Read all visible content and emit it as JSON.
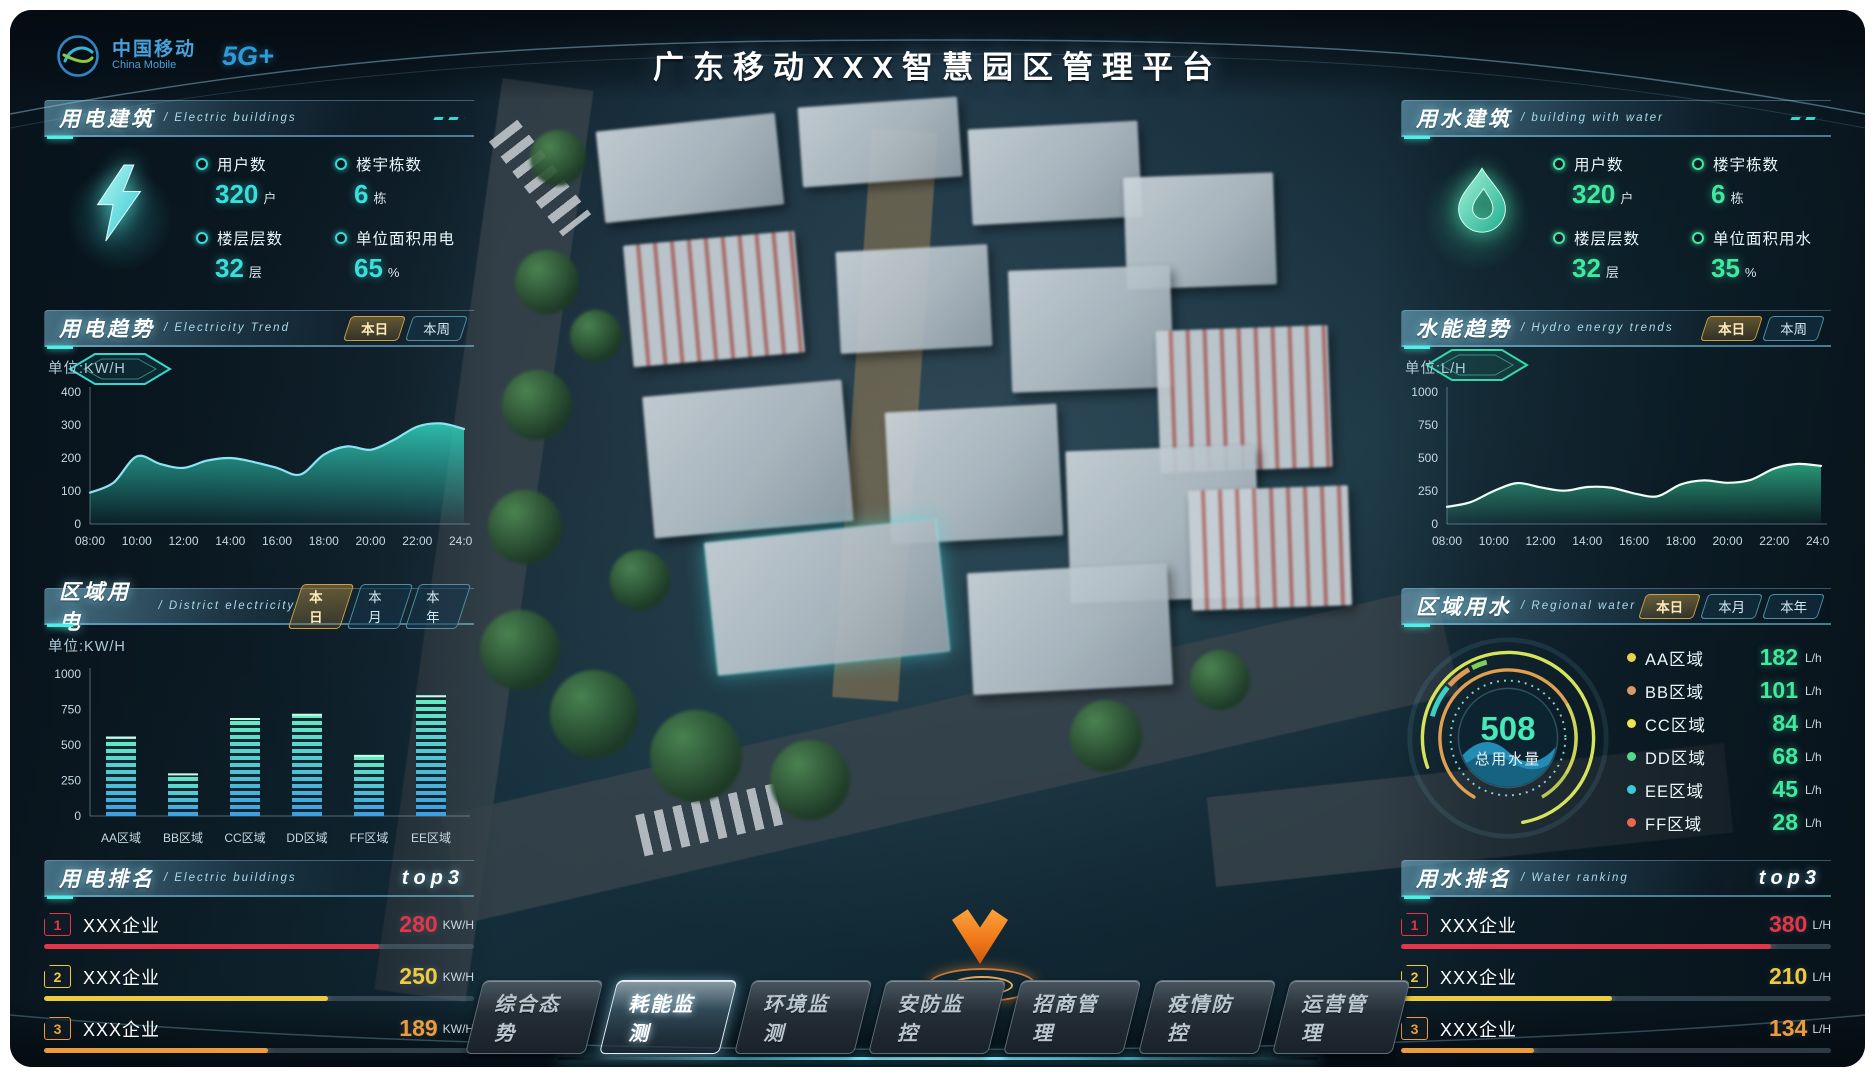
{
  "colors": {
    "accent_electric": "#35dcd4",
    "accent_water": "#3fe9a0",
    "tab_active_border": "#cf9f3f",
    "rank1": "#e63448",
    "rank2": "#eccb3e",
    "rank3": "#ee9b3c"
  },
  "header": {
    "title": "广东移动XXX智慧园区管理平台",
    "logo_cn": "中国移动",
    "logo_en": "China Mobile",
    "logo_5g": "5G+"
  },
  "nav": {
    "items": [
      {
        "label": "综合态势",
        "active": false
      },
      {
        "label": "耗能监测",
        "active": true
      },
      {
        "label": "环境监测",
        "active": false
      },
      {
        "label": "安防监控",
        "active": false
      },
      {
        "label": "招商管理",
        "active": false
      },
      {
        "label": "疫情防控",
        "active": false
      },
      {
        "label": "运营管理",
        "active": false
      }
    ]
  },
  "left": {
    "building": {
      "title": "用电建筑",
      "subtitle": "/ Electric buildings",
      "stats": [
        {
          "label": "用户数",
          "value": "320",
          "unit": "户"
        },
        {
          "label": "楼宇栋数",
          "value": "6",
          "unit": "栋"
        },
        {
          "label": "楼层层数",
          "value": "32",
          "unit": "层"
        },
        {
          "label": "单位面积用电",
          "value": "65",
          "unit": "%"
        }
      ]
    },
    "trend": {
      "title": "用电趋势",
      "subtitle": "/ Electricity Trend",
      "tabs": [
        {
          "label": "本日",
          "active": true
        },
        {
          "label": "本周",
          "active": false
        }
      ]
    },
    "district": {
      "title": "区域用电",
      "subtitle": "/ District electricity",
      "tabs": [
        {
          "label": "本日",
          "active": true
        },
        {
          "label": "本月",
          "active": false
        },
        {
          "label": "本年",
          "active": false
        }
      ]
    },
    "ranking": {
      "title": "用电排名",
      "subtitle": "/ Electric buildings",
      "badge": "top3",
      "rows": [
        {
          "rank": "1",
          "name": "XXX企业",
          "value": "280",
          "unit": "KW/H",
          "pct": 78,
          "color": "#e63448"
        },
        {
          "rank": "2",
          "name": "XXX企业",
          "value": "250",
          "unit": "KW/H",
          "pct": 66,
          "color": "#eccb3e"
        },
        {
          "rank": "3",
          "name": "XXX企业",
          "value": "189",
          "unit": "KW/H",
          "pct": 52,
          "color": "#ee9b3c"
        }
      ]
    }
  },
  "right": {
    "building": {
      "title": "用水建筑",
      "subtitle": "/ building with water",
      "stats": [
        {
          "label": "用户数",
          "value": "320",
          "unit": "户"
        },
        {
          "label": "楼宇栋数",
          "value": "6",
          "unit": "栋"
        },
        {
          "label": "楼层层数",
          "value": "32",
          "unit": "层"
        },
        {
          "label": "单位面积用水",
          "value": "35",
          "unit": "%"
        }
      ]
    },
    "trend": {
      "title": "水能趋势",
      "subtitle": "/ Hydro energy trends",
      "tabs": [
        {
          "label": "本日",
          "active": true
        },
        {
          "label": "本周",
          "active": false
        }
      ]
    },
    "regional": {
      "title": "区域用水",
      "subtitle": "/ Regional water",
      "tabs": [
        {
          "label": "本日",
          "active": true
        },
        {
          "label": "本月",
          "active": false
        },
        {
          "label": "本年",
          "active": false
        }
      ]
    },
    "ranking": {
      "title": "用水排名",
      "subtitle": "/ Water ranking",
      "badge": "top3",
      "rows": [
        {
          "rank": "1",
          "name": "XXX企业",
          "value": "380",
          "unit": "L/H",
          "pct": 86,
          "color": "#e63448"
        },
        {
          "rank": "2",
          "name": "XXX企业",
          "value": "210",
          "unit": "L/H",
          "pct": 49,
          "color": "#eccb3e"
        },
        {
          "rank": "3",
          "name": "XXX企业",
          "value": "134",
          "unit": "L/H",
          "pct": 31,
          "color": "#ee9b3c"
        }
      ]
    }
  },
  "chart_data": [
    {
      "id": "electricity-trend",
      "type": "area",
      "unit_label": "单位:KW/H",
      "x": [
        "08:00",
        "10:00",
        "12:00",
        "14:00",
        "16:00",
        "18:00",
        "20:00",
        "22:00",
        "24:00"
      ],
      "values": [
        95,
        125,
        205,
        182,
        170,
        192,
        200,
        188,
        170,
        150,
        210,
        235,
        225,
        255,
        295,
        305,
        288
      ],
      "ylim": [
        0,
        400
      ],
      "yticks": [
        0,
        100,
        200,
        300,
        400
      ],
      "line_color": "#8ce4f2",
      "area_color": "#2fd4be"
    },
    {
      "id": "hydro-trend",
      "type": "area",
      "unit_label": "单位:L/H",
      "x": [
        "08:00",
        "10:00",
        "12:00",
        "14:00",
        "16:00",
        "18:00",
        "20:00",
        "22:00",
        "24:00"
      ],
      "values": [
        130,
        165,
        250,
        310,
        278,
        252,
        280,
        276,
        232,
        210,
        300,
        330,
        312,
        335,
        420,
        455,
        440
      ],
      "ylim": [
        0,
        1000
      ],
      "yticks": [
        0,
        250,
        500,
        750,
        1000
      ],
      "line_color": "#eefff8",
      "area_color": "#2fae86"
    },
    {
      "id": "district-electricity",
      "type": "bar",
      "unit_label": "单位:KW/H",
      "categories": [
        "AA区域",
        "BB区域",
        "CC区域",
        "DD区域",
        "FF区域",
        "EE区域"
      ],
      "values": [
        560,
        300,
        690,
        720,
        430,
        850
      ],
      "ylim": [
        0,
        1000
      ],
      "yticks": [
        0,
        250,
        500,
        750,
        1000
      ]
    },
    {
      "id": "regional-water",
      "type": "donut",
      "total": "508",
      "total_label": "总用水量",
      "legend": [
        {
          "label": "AA区域",
          "value": "182",
          "unit": "L/h",
          "color": "#e6d44e"
        },
        {
          "label": "BB区域",
          "value": "101",
          "unit": "L/h",
          "color": "#d8986a"
        },
        {
          "label": "CC区域",
          "value": "84",
          "unit": "L/h",
          "color": "#eee44e"
        },
        {
          "label": "DD区域",
          "value": "68",
          "unit": "L/h",
          "color": "#55d88d"
        },
        {
          "label": "EE区域",
          "value": "45",
          "unit": "L/h",
          "color": "#3cc8d8"
        },
        {
          "label": "FF区域",
          "value": "28",
          "unit": "L/h",
          "color": "#e8684a"
        }
      ]
    }
  ]
}
